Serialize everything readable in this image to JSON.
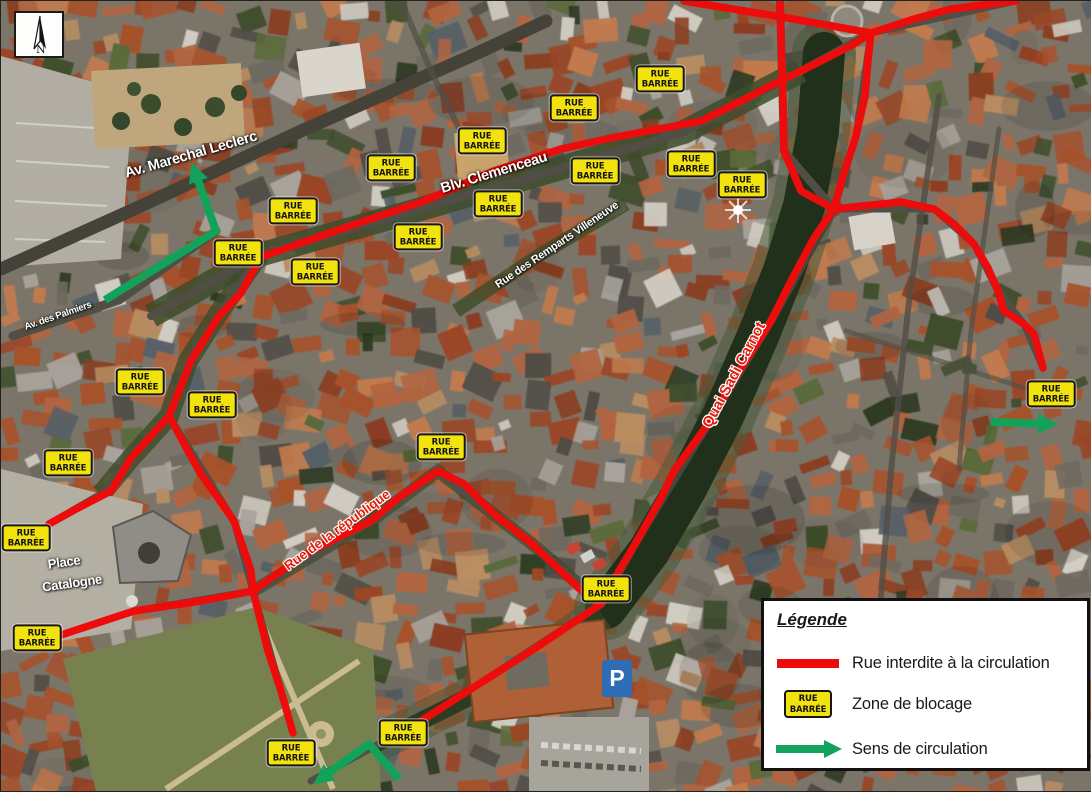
{
  "north_indicator": {
    "label": "N"
  },
  "parking_icon": {
    "label": "P"
  },
  "badge_text": {
    "line1": "RUE",
    "line2": "BARRÉE"
  },
  "colors": {
    "closed_street": "#ee0b0b",
    "blockade_badge": "#f2e20d",
    "badge_border": "#161616",
    "direction_arrow": "#13a259",
    "red_label_text": "#e0210f"
  },
  "street_labels": [
    {
      "text": "Av. Marechal Leclerc",
      "x": 190,
      "y": 154,
      "rot": -16,
      "size": 14.5,
      "style": "white"
    },
    {
      "text": "Blv. Clemenceau",
      "x": 493,
      "y": 172,
      "rot": -17,
      "size": 14.5,
      "style": "white"
    },
    {
      "text": "Rue des Remparts Villeneuve",
      "x": 556,
      "y": 244,
      "rot": -34,
      "size": 11,
      "style": "white"
    },
    {
      "text": "Av. des Palmiers",
      "x": 57,
      "y": 315,
      "rot": -19,
      "size": 9.5,
      "style": "white"
    },
    {
      "text": "Quai Sadi Carnot",
      "x": 733,
      "y": 374,
      "rot": -62,
      "size": 15,
      "style": "red"
    },
    {
      "text": "Rue de la république",
      "x": 336,
      "y": 529,
      "rot": -36,
      "size": 13.5,
      "style": "red"
    },
    {
      "text": "Place",
      "x": 63,
      "y": 561,
      "rot": -8,
      "size": 13,
      "style": "white"
    },
    {
      "text": "Catalogne",
      "x": 71,
      "y": 582,
      "rot": -8,
      "size": 13,
      "style": "white"
    }
  ],
  "closed_streets": [
    {
      "name": "blv-clemenceau",
      "points": [
        [
          260,
          256
        ],
        [
          343,
          227
        ],
        [
          423,
          200
        ],
        [
          493,
          170
        ],
        [
          560,
          148
        ],
        [
          610,
          137
        ],
        [
          700,
          120
        ],
        [
          740,
          100
        ],
        [
          773,
          83
        ],
        [
          810,
          65
        ],
        [
          853,
          43
        ],
        [
          870,
          32
        ]
      ]
    },
    {
      "name": "remparts-ouest",
      "points": [
        [
          260,
          256
        ],
        [
          240,
          292
        ],
        [
          218,
          315
        ],
        [
          190,
          360
        ],
        [
          168,
          415
        ],
        [
          130,
          457
        ],
        [
          110,
          490
        ],
        [
          77,
          507
        ],
        [
          48,
          523
        ]
      ]
    },
    {
      "name": "croisement-haut",
      "points": [
        [
          683,
          0
        ],
        [
          781,
          16
        ],
        [
          870,
          32
        ]
      ]
    },
    {
      "name": "verticale-castillet",
      "points": [
        [
          779,
          0
        ],
        [
          782,
          100
        ],
        [
          783,
          150
        ],
        [
          800,
          190
        ],
        [
          833,
          208
        ]
      ]
    },
    {
      "name": "sortie-nord-est",
      "points": [
        [
          870,
          32
        ],
        [
          913,
          18
        ],
        [
          950,
          8
        ],
        [
          1015,
          0
        ]
      ]
    },
    {
      "name": "liaison-carrefours",
      "points": [
        [
          870,
          32
        ],
        [
          867,
          60
        ],
        [
          864,
          95
        ],
        [
          855,
          135
        ],
        [
          842,
          175
        ],
        [
          833,
          208
        ]
      ]
    },
    {
      "name": "branche-est",
      "points": [
        [
          833,
          208
        ],
        [
          900,
          201
        ],
        [
          933,
          208
        ],
        [
          953,
          223
        ],
        [
          973,
          243
        ],
        [
          987,
          267
        ],
        [
          997,
          290
        ],
        [
          1003,
          310
        ],
        [
          1023,
          323
        ],
        [
          1033,
          333
        ],
        [
          1042,
          367
        ]
      ]
    },
    {
      "name": "quai-sadi-carnot",
      "points": [
        [
          833,
          208
        ],
        [
          813,
          237
        ],
        [
          790,
          280
        ],
        [
          770,
          320
        ],
        [
          740,
          367
        ],
        [
          707,
          423
        ],
        [
          673,
          470
        ],
        [
          660,
          497
        ],
        [
          640,
          533
        ],
        [
          618,
          570
        ],
        [
          600,
          603
        ]
      ]
    },
    {
      "name": "rue-de-la-republique",
      "points": [
        [
          252,
          590
        ],
        [
          270,
          577
        ],
        [
          310,
          550
        ],
        [
          370,
          520
        ],
        [
          397,
          497
        ],
        [
          437,
          470
        ],
        [
          463,
          483
        ],
        [
          493,
          513
        ],
        [
          530,
          542
        ],
        [
          583,
          592
        ],
        [
          600,
          603
        ]
      ]
    },
    {
      "name": "rive-sud",
      "points": [
        [
          600,
          603
        ],
        [
          530,
          650
        ],
        [
          470,
          688
        ],
        [
          420,
          720
        ]
      ]
    },
    {
      "name": "branche-diagonale",
      "points": [
        [
          168,
          415
        ],
        [
          198,
          470
        ],
        [
          233,
          520
        ],
        [
          250,
          570
        ],
        [
          252,
          590
        ]
      ]
    },
    {
      "name": "catalogne-sud",
      "points": [
        [
          252,
          590
        ],
        [
          200,
          600
        ],
        [
          133,
          610
        ],
        [
          57,
          635
        ]
      ]
    },
    {
      "name": "descente-sud",
      "points": [
        [
          252,
          590
        ],
        [
          267,
          650
        ],
        [
          280,
          690
        ],
        [
          292,
          732
        ]
      ]
    }
  ],
  "blockade_badges": [
    [
      659,
      78
    ],
    [
      573,
      107
    ],
    [
      481,
      140
    ],
    [
      390,
      167
    ],
    [
      594,
      170
    ],
    [
      690,
      163
    ],
    [
      741,
      184
    ],
    [
      497,
      203
    ],
    [
      292,
      210
    ],
    [
      417,
      236
    ],
    [
      237,
      252
    ],
    [
      314,
      271
    ],
    [
      139,
      381
    ],
    [
      211,
      404
    ],
    [
      67,
      462
    ],
    [
      440,
      446
    ],
    [
      25,
      537
    ],
    [
      36,
      637
    ],
    [
      605,
      588
    ],
    [
      1050,
      393
    ],
    [
      290,
      752
    ],
    [
      402,
      732
    ]
  ],
  "direction_arrows": [
    {
      "name": "fleche-palmiers",
      "points": [
        [
          104,
          299
        ],
        [
          215,
          230
        ],
        [
          193,
          168
        ]
      ]
    },
    {
      "name": "fleche-est",
      "points": [
        [
          990,
          421
        ],
        [
          1050,
          423
        ]
      ]
    },
    {
      "name": "fleche-sud",
      "points": [
        [
          398,
          778
        ],
        [
          368,
          743
        ],
        [
          318,
          779
        ]
      ]
    }
  ],
  "legend": {
    "title": "Légende",
    "items": [
      {
        "swatch": "red-line",
        "label": "Rue interdite à la circulation"
      },
      {
        "swatch": "rue-barree-badge",
        "label": "Zone de blocage"
      },
      {
        "swatch": "green-arrow",
        "label": "Sens de circulation"
      }
    ]
  }
}
